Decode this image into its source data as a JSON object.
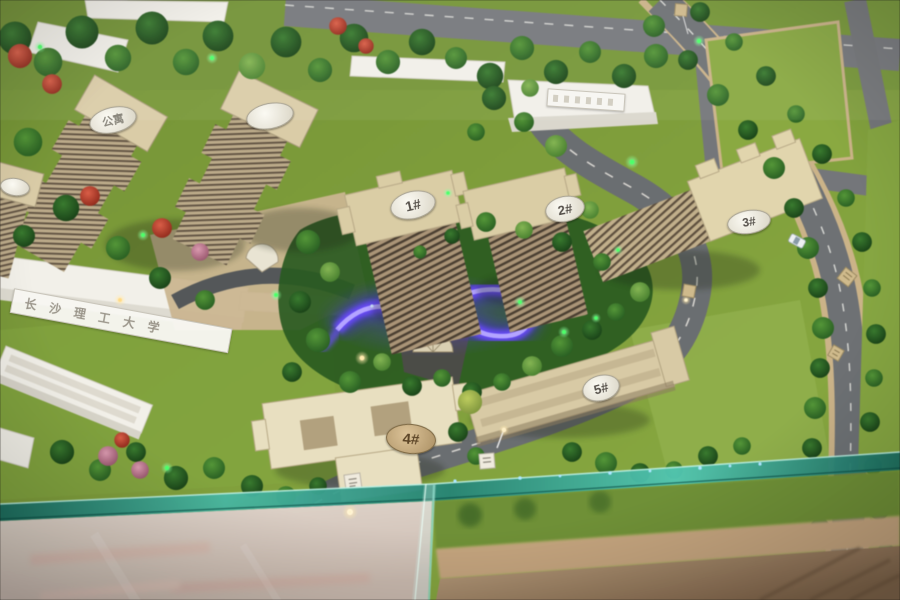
{
  "labels": {
    "building_1": "1#",
    "building_2": "2#",
    "building_3": "3#",
    "building_4": "4#",
    "building_5": "5#",
    "apartment_tower": "公寓",
    "university_building": "长沙理工大学"
  },
  "colors": {
    "grass": "#7e9a3e",
    "road": "#73767a",
    "building_tan": "#d2c5a2",
    "building_white": "#f0eee7",
    "water_glow": "#5b3df0",
    "glass_edge": "#3aa18f",
    "floor_left": "#d6cac0",
    "floor_right": "#a98e72",
    "led_green": "#4dff66"
  }
}
